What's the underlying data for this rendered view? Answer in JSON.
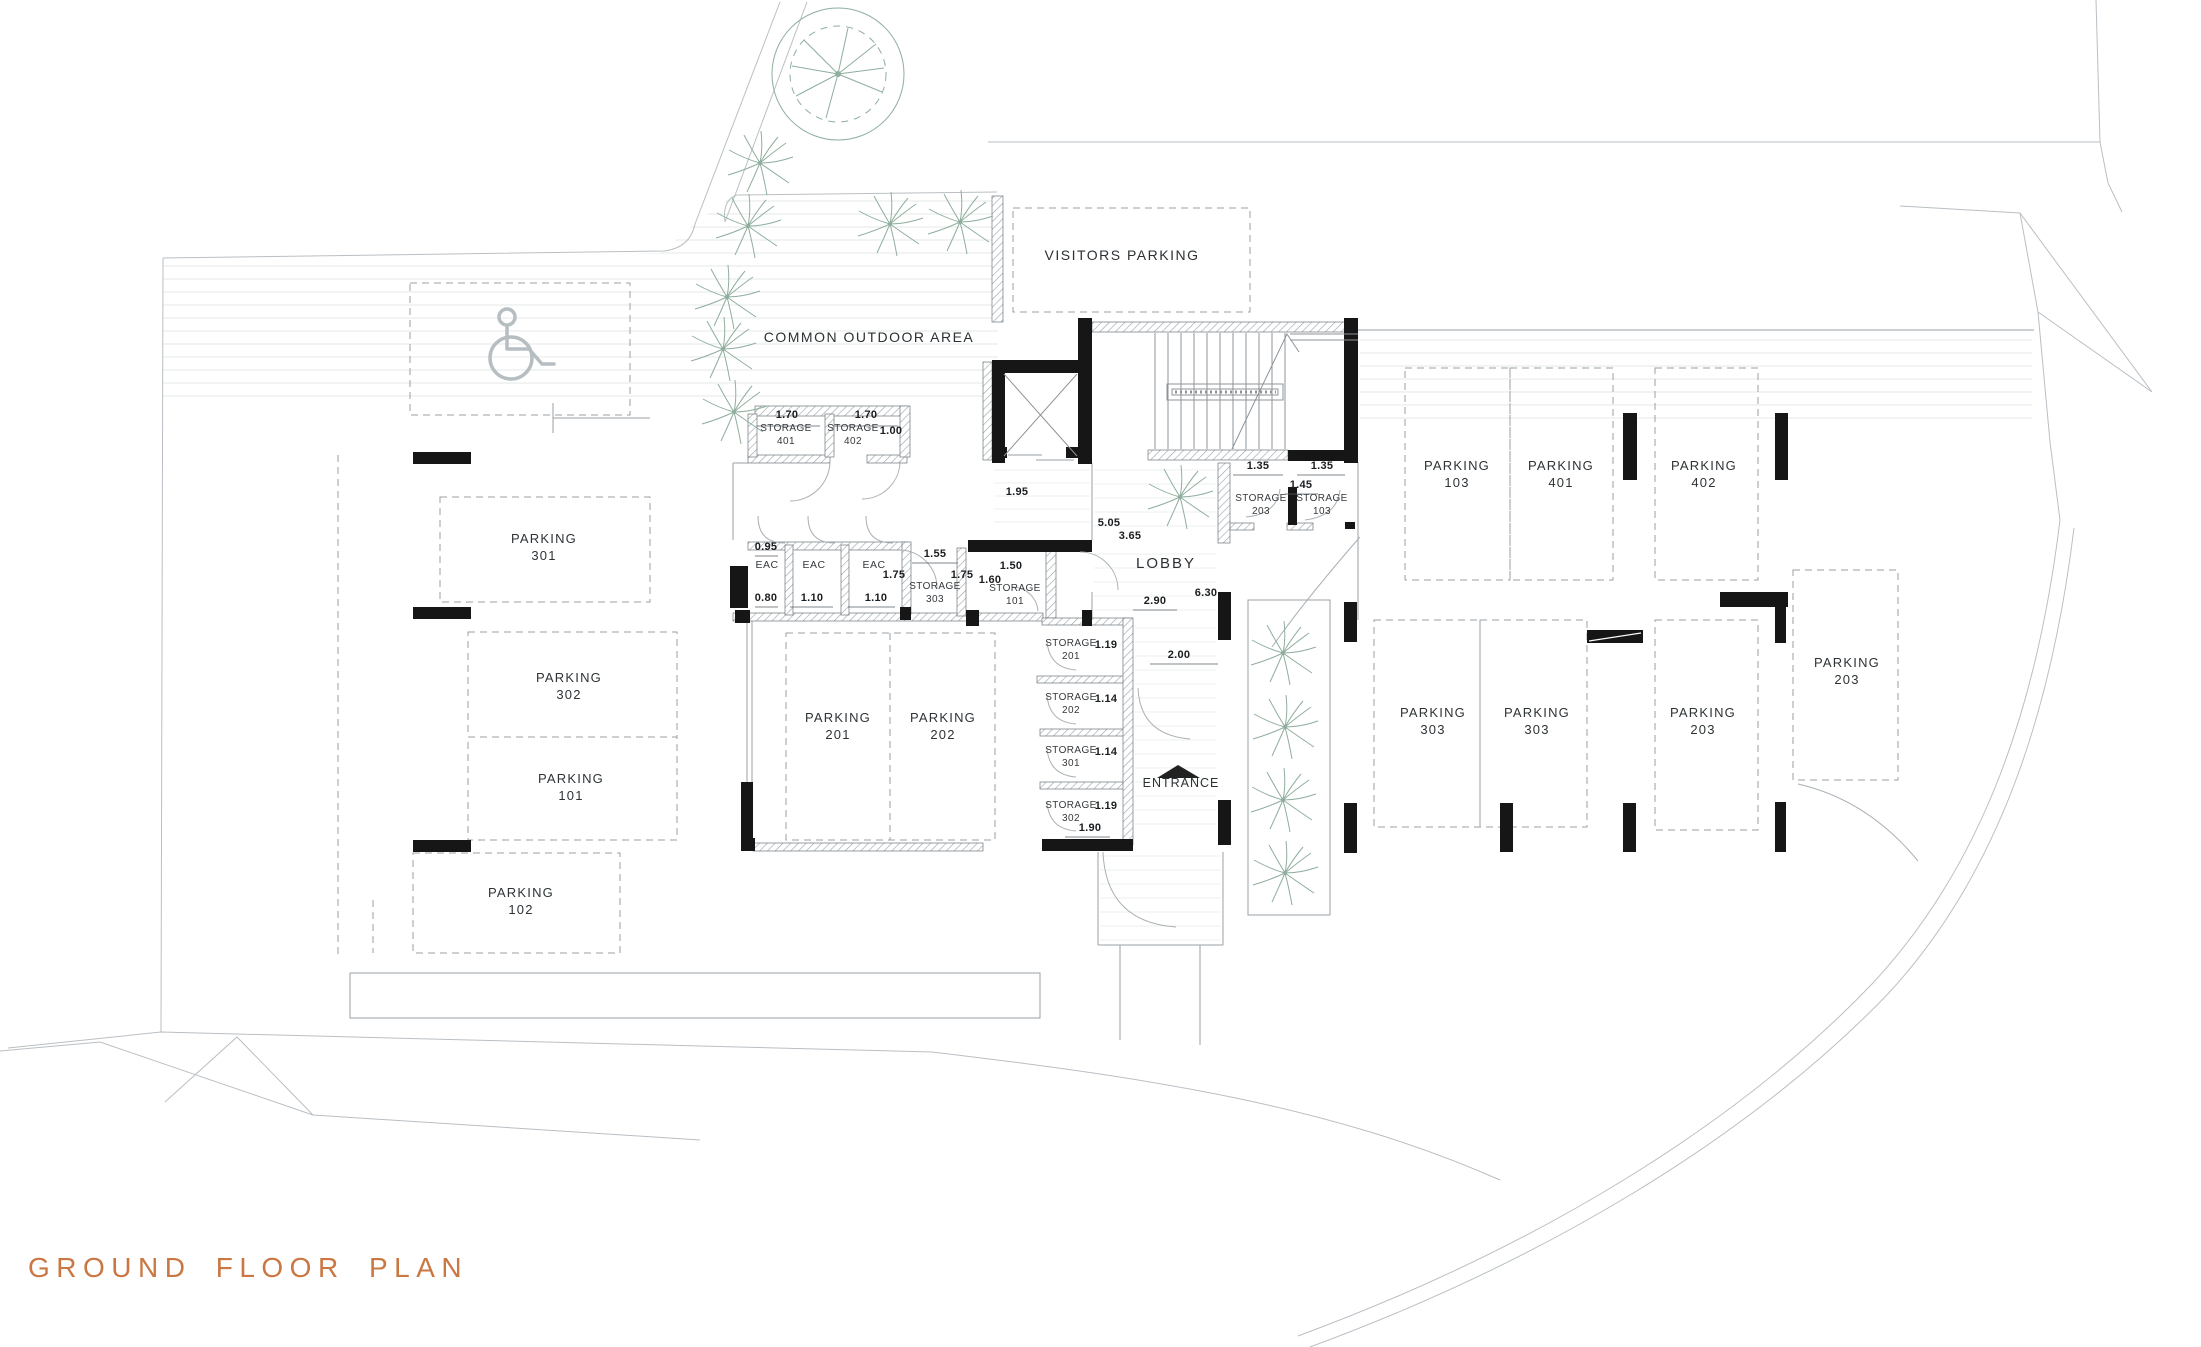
{
  "title": {
    "text": "GROUND FLOOR PLAN",
    "color": "#cb7743"
  },
  "areas": {
    "visitors_parking": "VISITORS PARKING",
    "common_outdoor_area": "COMMON OUTDOOR AREA",
    "lobby": "LOBBY",
    "entrance": "ENTRANCE"
  },
  "parking_spots": [
    {
      "label": "PARKING",
      "number": "301"
    },
    {
      "label": "PARKING",
      "number": "302"
    },
    {
      "label": "PARKING",
      "number": "101"
    },
    {
      "label": "PARKING",
      "number": "102"
    },
    {
      "label": "PARKING",
      "number": "201"
    },
    {
      "label": "PARKING",
      "number": "202"
    },
    {
      "label": "PARKING",
      "number": "103"
    },
    {
      "label": "PARKING",
      "number": "401"
    },
    {
      "label": "PARKING",
      "number": "402"
    },
    {
      "label": "PARKING",
      "number": "303"
    },
    {
      "label": "PARKING",
      "number": "303"
    },
    {
      "label": "PARKING",
      "number": "203"
    },
    {
      "label": "PARKING",
      "number": "203"
    }
  ],
  "storage_rooms": [
    {
      "label": "STORAGE",
      "number": "401"
    },
    {
      "label": "STORAGE",
      "number": "402"
    },
    {
      "label": "STORAGE",
      "number": "303"
    },
    {
      "label": "STORAGE",
      "number": "101"
    },
    {
      "label": "STORAGE",
      "number": "203"
    },
    {
      "label": "STORAGE",
      "number": "103"
    },
    {
      "label": "STORAGE",
      "number": "201"
    },
    {
      "label": "STORAGE",
      "number": "202"
    },
    {
      "label": "STORAGE",
      "number": "301"
    },
    {
      "label": "STORAGE",
      "number": "302"
    }
  ],
  "eac_label": "EAC",
  "dimensions": [
    "1.70",
    "1.70",
    "1.00",
    "1.95",
    "0.95",
    "0.80",
    "1.10",
    "1.10",
    "1.55",
    "1.75",
    "1.75",
    "1.50",
    "1.60",
    "5.05",
    "3.65",
    "2.90",
    "6.30",
    "1.35",
    "1.35",
    "1.45",
    "1.19",
    "2.00",
    "1.14",
    "1.14",
    "1.19",
    "1.90"
  ],
  "icons": {
    "accessible_parking": "wheelchair-icon",
    "entrance_marker": "entrance-arrow-icon"
  },
  "colors": {
    "walls": "#161616",
    "plants": "#8fae9d",
    "site_lines": "#b9bfc4"
  }
}
